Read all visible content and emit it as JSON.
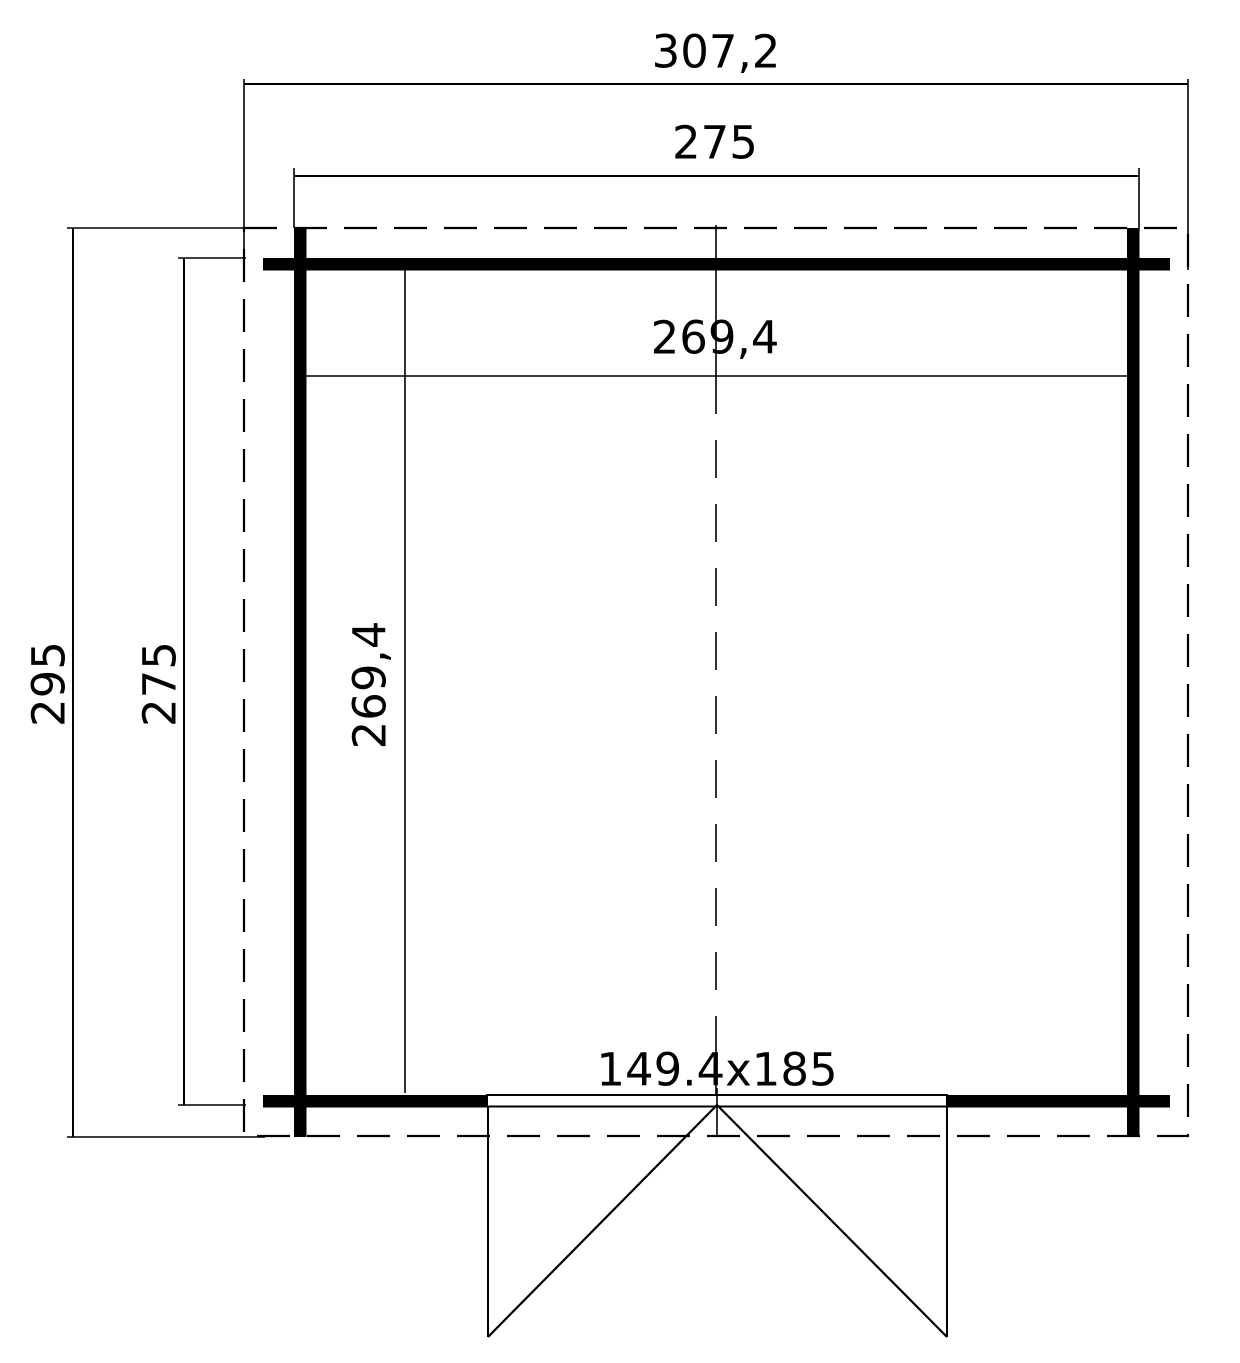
{
  "drawing": {
    "type": "floor-plan",
    "background_color": "#ffffff",
    "line_color": "#000000",
    "labels": {
      "overall_width": "307,2",
      "outer_wall_width": "275",
      "overall_depth": "295",
      "outer_wall_depth": "275",
      "interior_width": "269,4",
      "interior_depth": "269,4",
      "door_size": "149.4x185"
    }
  }
}
